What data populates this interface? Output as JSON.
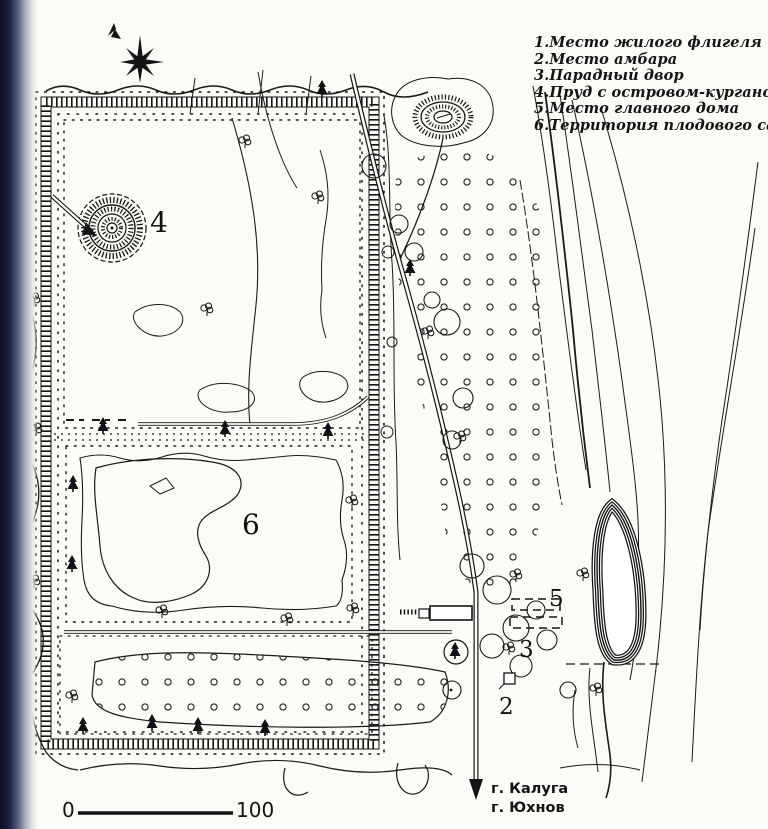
{
  "legend": {
    "items": [
      {
        "text": "1.Место жилого флигеля"
      },
      {
        "text": "2.Место амбара"
      },
      {
        "text": "3.Парадный двор"
      },
      {
        "text": "4.Пруд с островом-курганом"
      },
      {
        "text": "5.Место главного дома"
      },
      {
        "text": "6.Территория плодового сада"
      }
    ]
  },
  "map_labels": {
    "pond_island_kurgan": "4",
    "orchard_territory": "6",
    "main_house_site": "5",
    "front_yard": "3",
    "barn_site": "2"
  },
  "scale_bar": {
    "start": "0",
    "end": "100"
  },
  "road_destinations": {
    "city1": "г. Калуга",
    "city2": "г. Юхнов"
  },
  "colors": {
    "ink": "#1a1a1a",
    "paper": "#fcfbf7"
  }
}
